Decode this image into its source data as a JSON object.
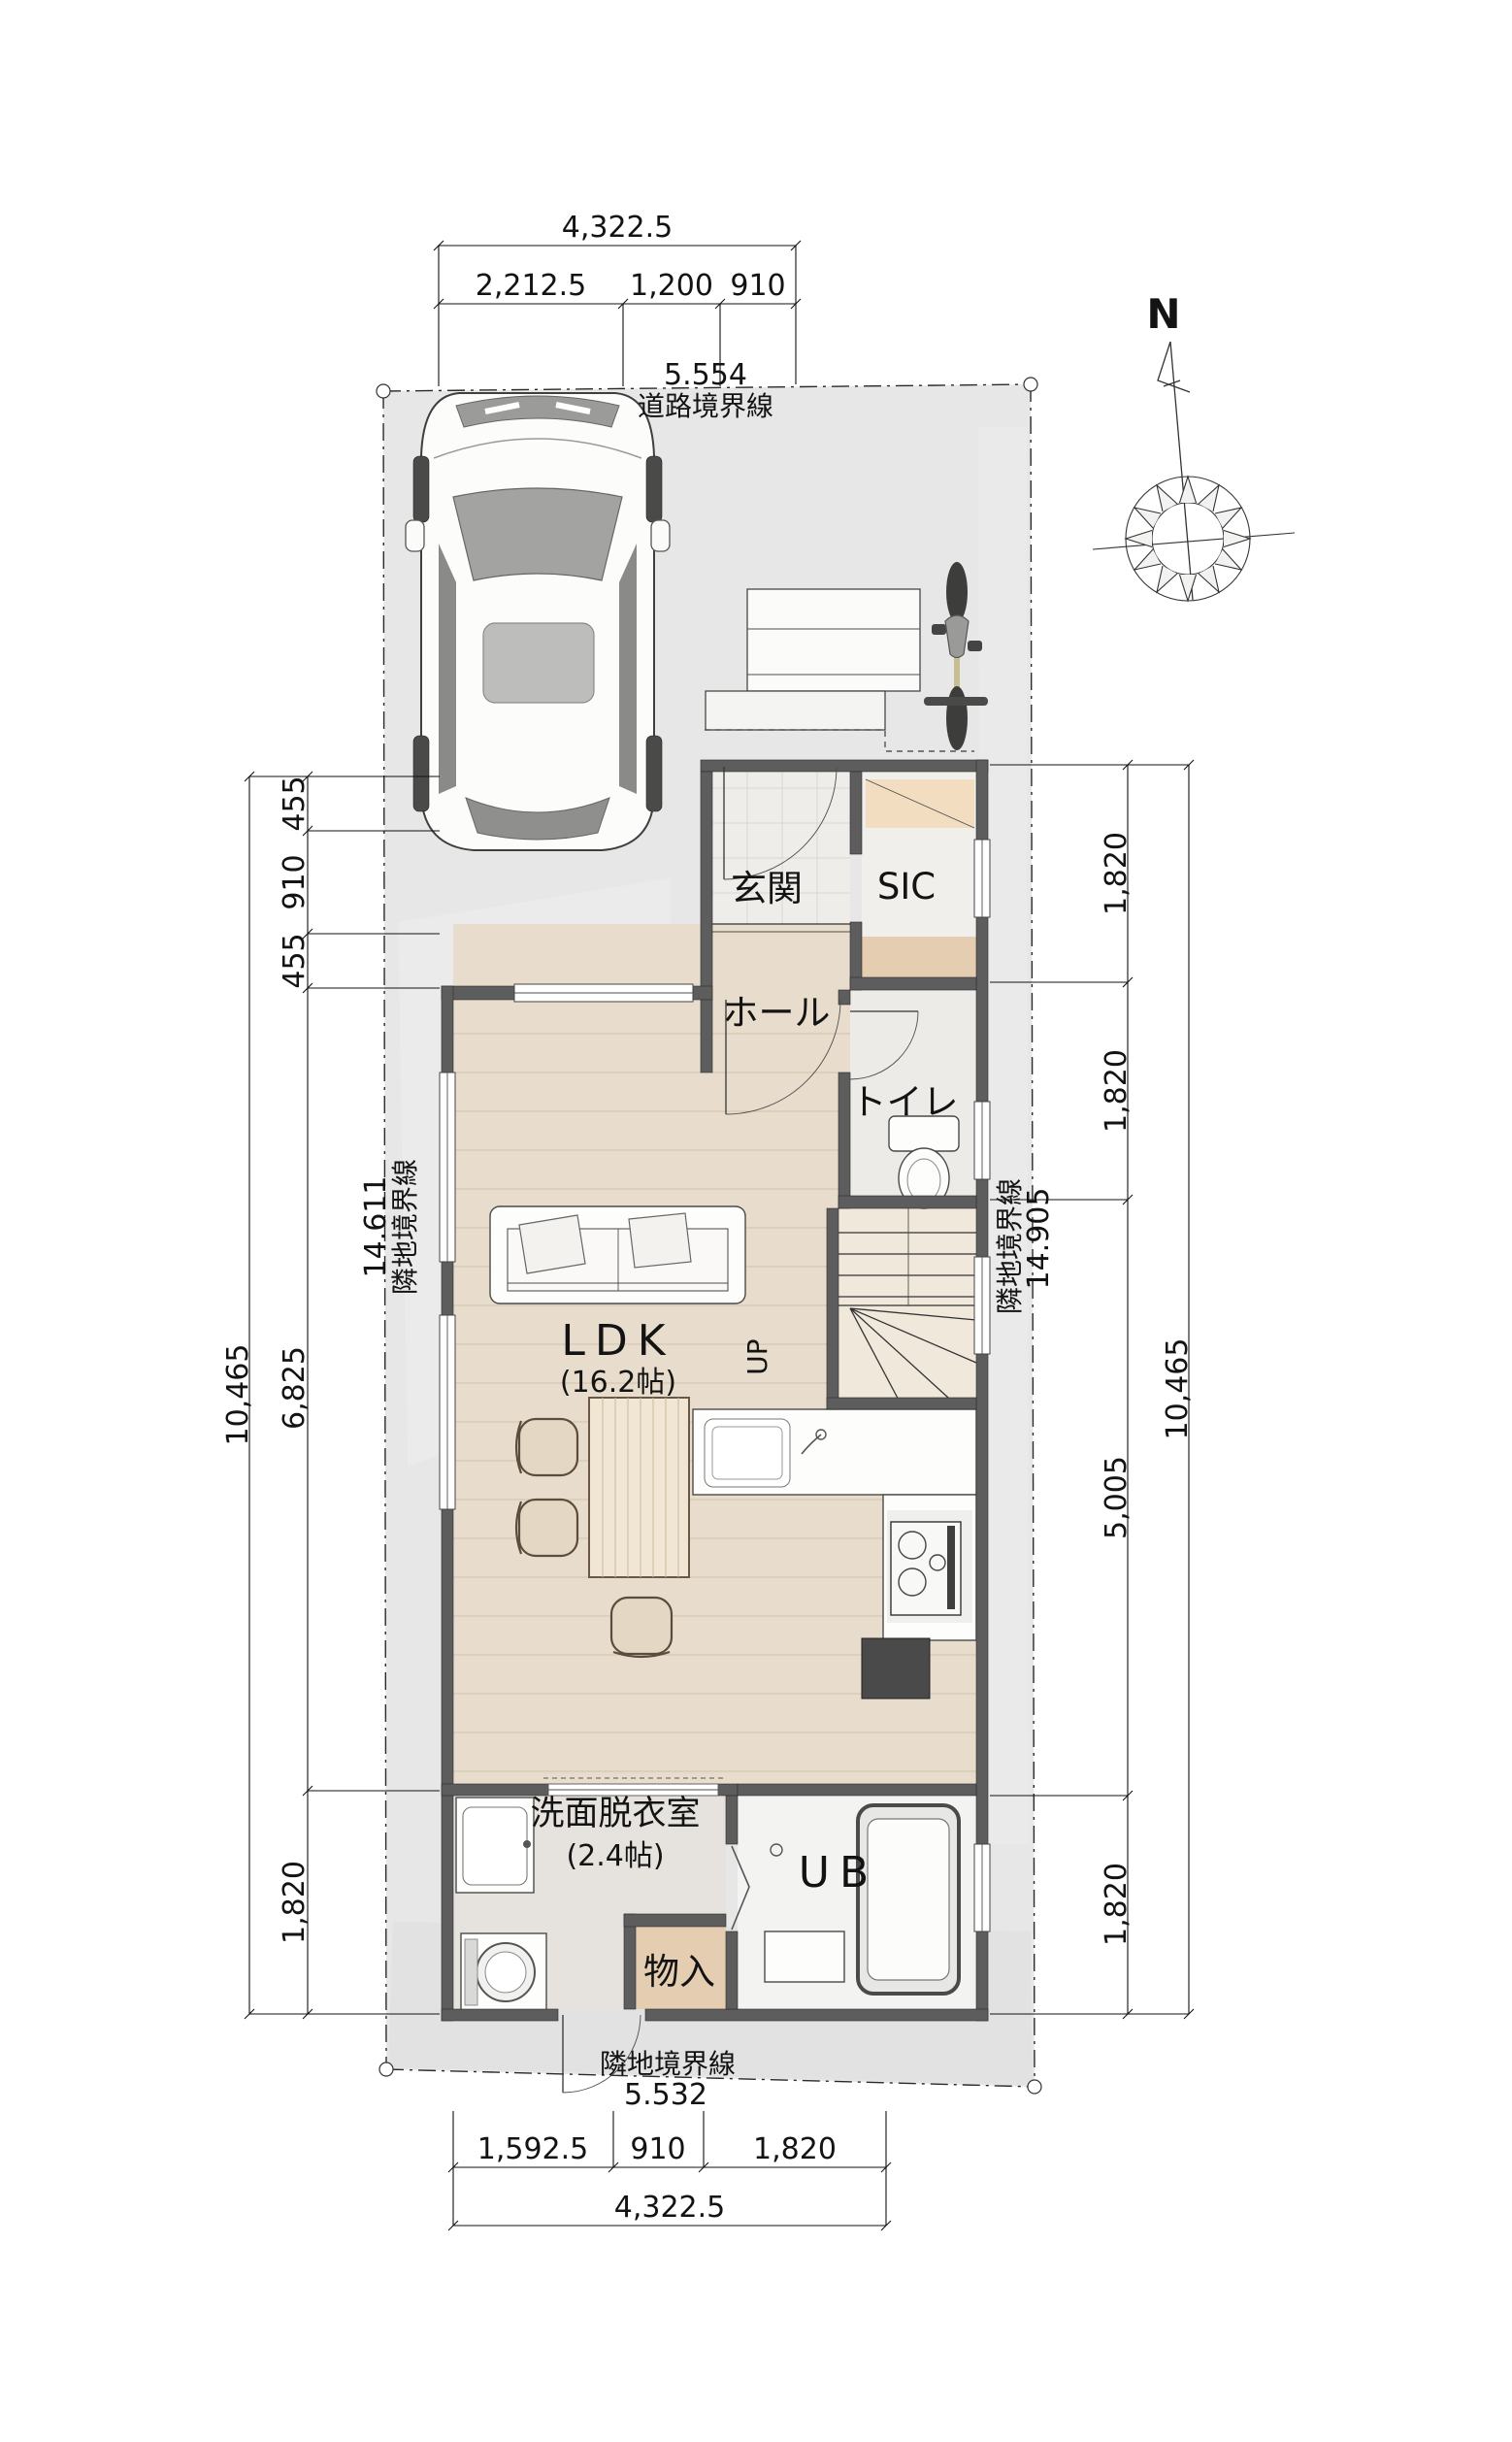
{
  "compass": {
    "north_label": "N"
  },
  "boundaries": {
    "road": {
      "label": "道路境界線",
      "length": "5.554"
    },
    "left": {
      "label": "隣地境界線",
      "length": "14.611"
    },
    "right": {
      "label": "隣地境界線",
      "length": "14.905"
    },
    "bottom": {
      "label": "隣地境界線",
      "length": "5.532"
    }
  },
  "dimensions": {
    "top": {
      "total": "4,322.5",
      "segments": [
        "2,212.5",
        "1,200",
        "910"
      ]
    },
    "bottom": {
      "total": "4,322.5",
      "segments": [
        "1,592.5",
        "910",
        "1,820"
      ]
    },
    "left": {
      "total": "10,465",
      "segments": [
        "455",
        "910",
        "455",
        "6,825",
        "1,820"
      ]
    },
    "right": {
      "total": "10,465",
      "segments": [
        "1,820",
        "1,820",
        "5,005",
        "1,820"
      ]
    }
  },
  "rooms": {
    "genkan": "玄関",
    "sic": "SIC",
    "hall": "ホール",
    "toilet": "トイレ",
    "ldk": "LDK",
    "ldk_size": "(16.2帖)",
    "stairs_up": "UP",
    "washroom": "洗面脱衣室",
    "washroom_size": "(2.4帖)",
    "bath": "UB",
    "storage": "物入"
  },
  "colors": {
    "lot": "#e7e7e8",
    "wall": "#5d5d5d",
    "wood": "#e8ddcc",
    "tile": "#efedea",
    "stairs": "#f0e8da",
    "wash": "#e6e3df",
    "bath": "#f3f3f1",
    "storage_tan": "#e4cdb0",
    "closet_peach": "#f3ddc0"
  }
}
